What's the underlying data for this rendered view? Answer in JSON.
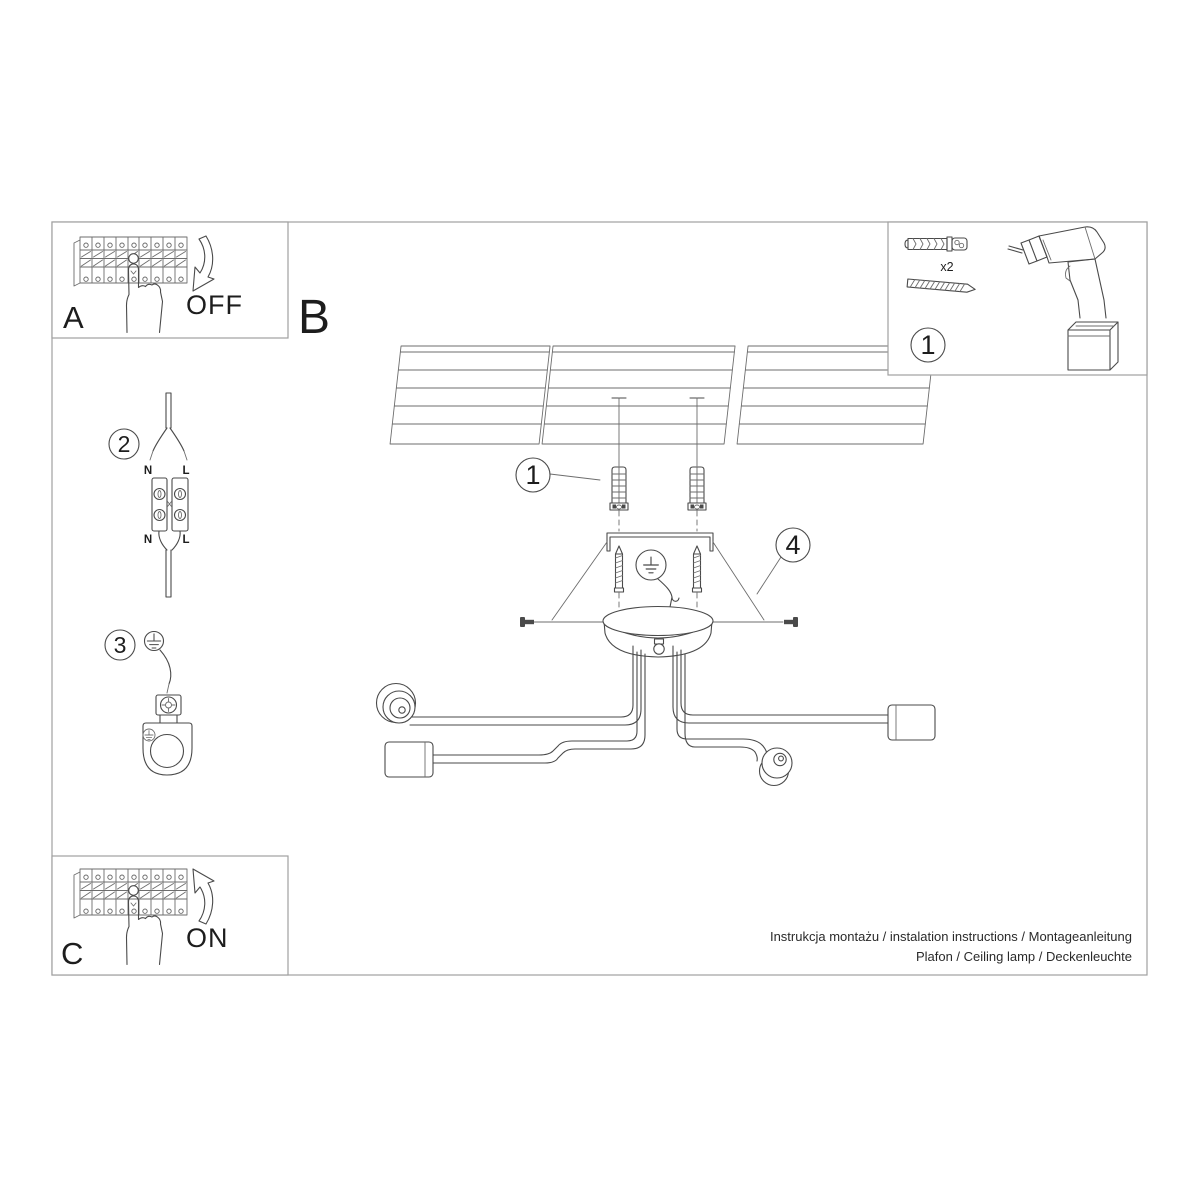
{
  "page": {
    "footer": {
      "line1": "Instrukcja montażu / instalation instructions / Montageanleitung",
      "line2": "Plafon / Ceiling lamp / Deckenleuchte"
    }
  },
  "sections": {
    "a": {
      "label": "A",
      "state": "OFF"
    },
    "b": {
      "label": "B"
    },
    "c": {
      "label": "C",
      "state": "ON"
    }
  },
  "callouts": {
    "tools": "1",
    "dowels": "1",
    "wiring": "2",
    "ground": "3",
    "mounting": "4"
  },
  "tools_panel": {
    "dowel_quantity": "x2"
  },
  "wiring_labels": {
    "top_n": "N",
    "top_l": "L",
    "bottom_n": "N",
    "bottom_l": "L"
  },
  "colors": {
    "line": "#4a4a4a",
    "panel_border": "#a0a0a0",
    "text": "#1d1d1d"
  }
}
